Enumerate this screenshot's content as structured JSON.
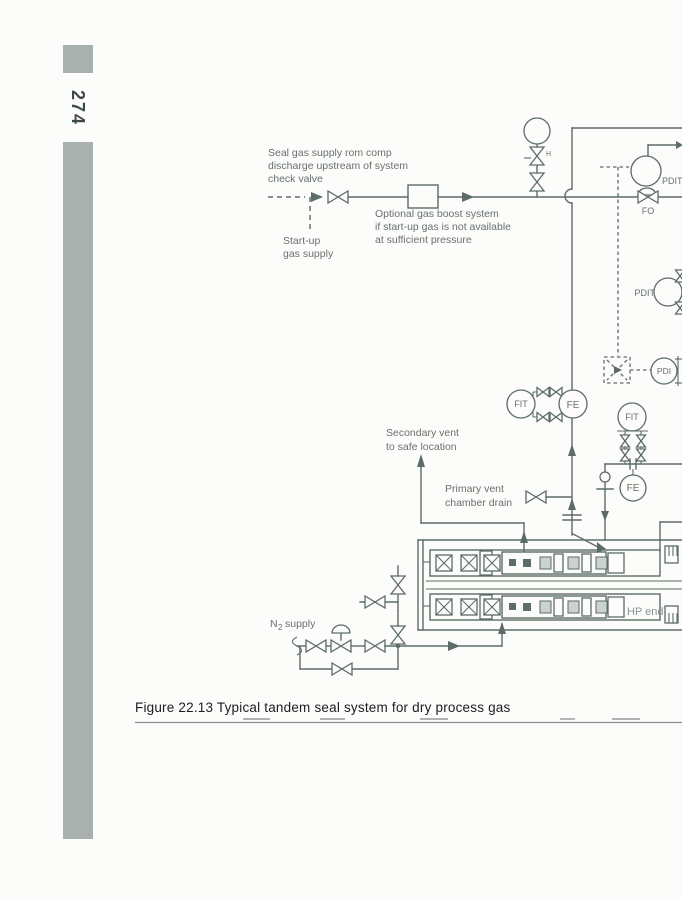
{
  "page": {
    "number": "274",
    "caption": "Figure 22.13 Typical tandem seal system for dry process gas"
  },
  "colors": {
    "sidebar_gray": "#a9b1ae",
    "diagram_line": "#5d6c66",
    "label_text": "#67716b",
    "caption_text": "#1d1d1d",
    "paper": "#fcfcfb"
  },
  "diagram": {
    "labels": {
      "seal_supply": [
        "Seal gas supply rom comp",
        "discharge upstream of system",
        "check valve"
      ],
      "startup": [
        "Start-up",
        "gas supply"
      ],
      "boost": [
        "Optional gas boost system",
        "if start-up gas is not available",
        "at sufficient pressure"
      ],
      "secondary_vent": [
        "Secondary vent",
        "to safe location"
      ],
      "primary_vent": [
        "Primary vent",
        "chamber drain"
      ],
      "n2": {
        "base": "N",
        "sub": "2",
        "rest": "supply"
      },
      "hp_end": "HP end",
      "fo": "FO",
      "h_mark": "H"
    },
    "instruments": {
      "pdit_top": "PDIT",
      "pdit_mid": "PDIT",
      "pdi": "PDI",
      "fit_left": "FIT",
      "fe_left": "FE",
      "fit_right": "FIT",
      "fe_right": "FE"
    }
  }
}
